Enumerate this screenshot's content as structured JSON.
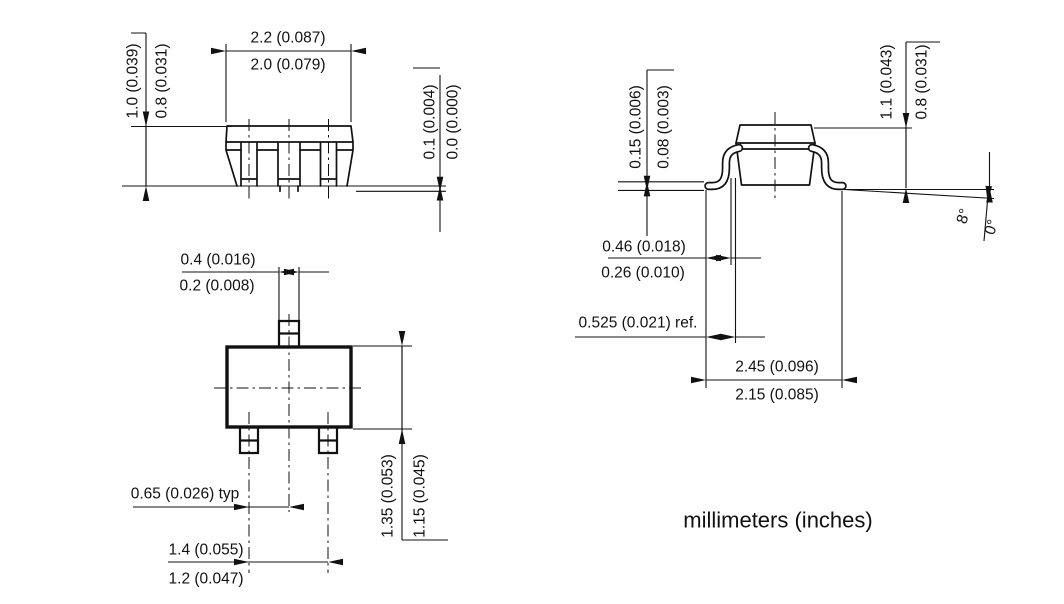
{
  "units_note": "millimeters (inches)",
  "front_view": {
    "body_width_max": "2.2 (0.087)",
    "body_width_min": "2.0 (0.079)",
    "body_height_max": "1.0 (0.039)",
    "body_height_min": "0.8 (0.031)",
    "standoff_max": "0.1 (0.004)",
    "standoff_min": "0.0 (0.000)"
  },
  "top_view": {
    "lead_width_max": "0.4 (0.016)",
    "lead_width_min": "0.2 (0.008)",
    "lead_pitch": "0.65 (0.026) typ",
    "outer_lead_span_max": "1.4 (0.055)",
    "outer_lead_span_min": "1.2 (0.047)",
    "body_depth_max": "1.35 (0.053)",
    "body_depth_min": "1.15 (0.045)"
  },
  "side_view": {
    "lead_thickness_max": "0.15 (0.006)",
    "lead_thickness_min": "0.08 (0.003)",
    "foot_length_max": "0.46 (0.018)",
    "foot_length_min": "0.26 (0.010)",
    "foot_ref": "0.525 (0.021) ref.",
    "lead_span_max": "2.45 (0.096)",
    "lead_span_min": "2.15 (0.085)",
    "height_max": "1.1 (0.043)",
    "height_min": "0.8 (0.031)",
    "foot_angle_max": "8°",
    "foot_angle_min": "0°"
  }
}
